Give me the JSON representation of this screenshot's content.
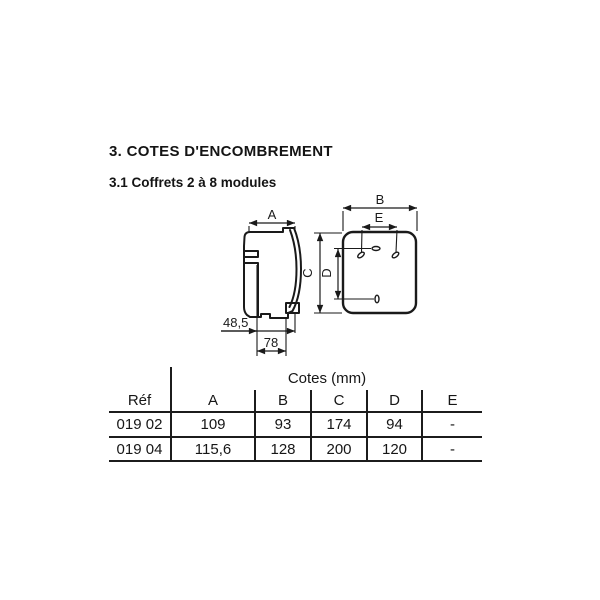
{
  "page": {
    "title": "3. COTES D'ENCOMBREMENT",
    "subtitle": "3.1 Coffrets 2 à 8 modules"
  },
  "diagram": {
    "side_view": {
      "dim_a": "A",
      "dim_offset": "48,5",
      "dim_depth": "78"
    },
    "front_view": {
      "dim_b": "B",
      "dim_e": "E",
      "dim_c": "C",
      "dim_d": "D"
    }
  },
  "table": {
    "group_header": "Cotes (mm)",
    "columns": [
      "Réf",
      "A",
      "B",
      "C",
      "D",
      "E"
    ],
    "rows": [
      {
        "ref": "019 02",
        "a": "109",
        "b": "93",
        "c": "174",
        "d": "94",
        "e": "-"
      },
      {
        "ref": "019 04",
        "a": "115,6",
        "b": "128",
        "c": "200",
        "d": "120",
        "e": "-"
      }
    ]
  },
  "colors": {
    "ink": "#1a1a1a",
    "paper": "#ffffff"
  }
}
